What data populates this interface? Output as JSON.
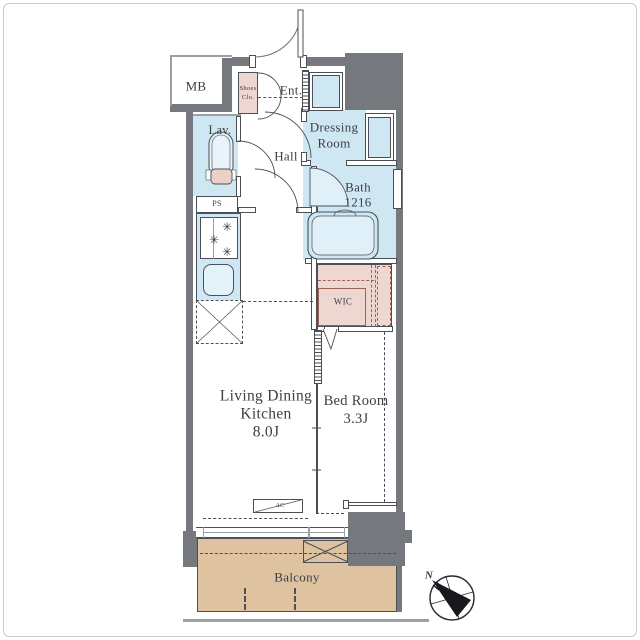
{
  "plan_type": "apartment-floorplan",
  "rooms": {
    "mb": {
      "label": "MB"
    },
    "entrance": {
      "label": "Ent."
    },
    "shoes_closet": {
      "line1": "Shoes",
      "line2": "Clo."
    },
    "dressing_room": {
      "line1": "Dressing",
      "line2": "Room"
    },
    "lavatory": {
      "label": "Lav."
    },
    "hall": {
      "label": "Hall"
    },
    "bath": {
      "label": "Bath",
      "size": "1216"
    },
    "pipe_space": {
      "label": "PS"
    },
    "wic": {
      "label": "WIC"
    },
    "ldk": {
      "line1": "Living Dining",
      "line2": "Kitchen",
      "size": "8.0J"
    },
    "bedroom": {
      "line1": "Bed Room",
      "size": "3.3J"
    },
    "balcony": {
      "label": "Balcony"
    },
    "ac": {
      "label": "AC"
    }
  },
  "compass": {
    "north_label": "N",
    "needle_direction": "northwest"
  },
  "colors": {
    "wall": "#75797e",
    "line": "#4a5055",
    "wet_area_blue": "#cfe7f2",
    "closet_pink": "#eed7d0",
    "balcony_tan": "#dfc3a0",
    "text": "#3b4045"
  }
}
